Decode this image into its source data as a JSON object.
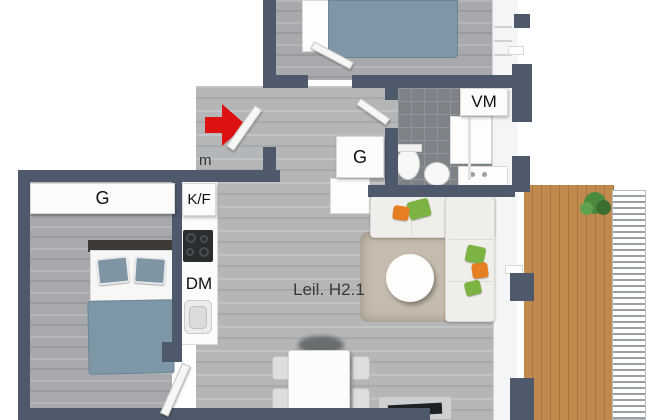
{
  "unit_label": "Leil. H2.1",
  "partial_label": "m",
  "rooms": {
    "bedroom_main": {
      "wardrobe_label": "G"
    },
    "hall": {
      "wardrobe_label": "G"
    },
    "kitchen": {
      "fridge_freezer_label": "K/F",
      "dishwasher_label": "DM"
    },
    "bathroom": {
      "washing_machine_label": "VM"
    }
  },
  "colors": {
    "wall": "#4e5a6b",
    "floor_living": "#b4b6b8",
    "floor_bedroom": "#a7a9ac",
    "floor_bathroom_tile": "#7d8287",
    "balcony_wood": "#bf8a4d",
    "bed_textile": "#7e96a5",
    "entrance_arrow": "#dd1111",
    "pillow_green": "#7cb342",
    "pillow_orange": "#e67e22",
    "label_text": "#111111"
  }
}
